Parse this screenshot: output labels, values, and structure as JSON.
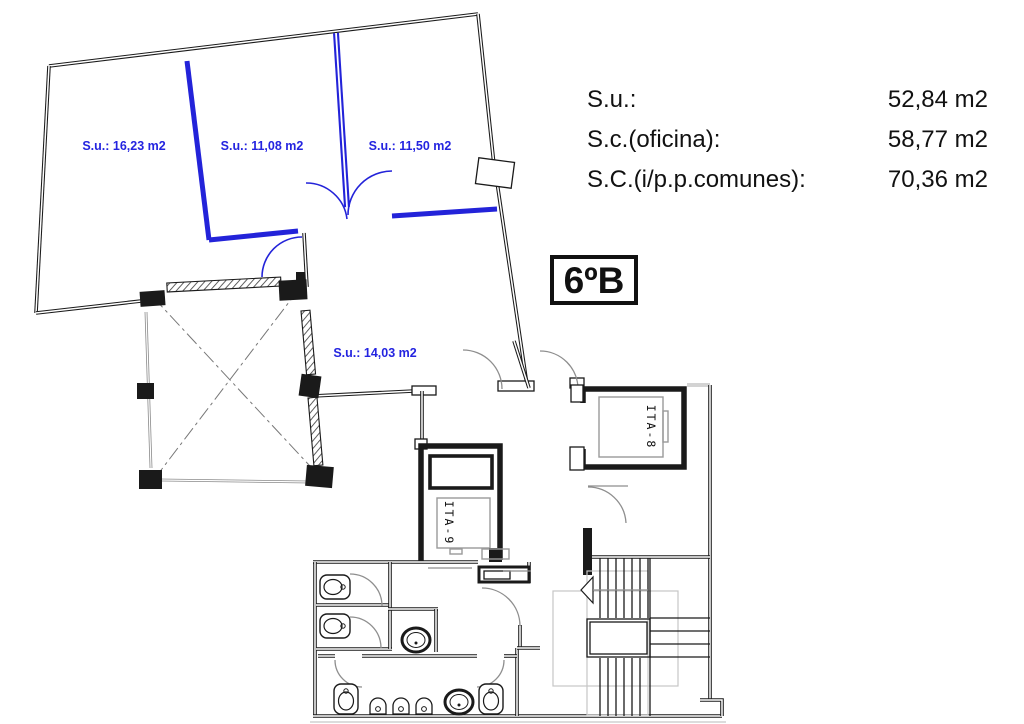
{
  "unit_box": {
    "label": "6ºB"
  },
  "legend": {
    "rows": [
      {
        "label": "S.u.:",
        "value": "52,84 m2"
      },
      {
        "label": "S.c.(oficina):",
        "value": "58,77 m2"
      },
      {
        "label": "S.C.(i/p.p.comunes):",
        "value": "70,36 m2"
      }
    ]
  },
  "room_labels": {
    "room1": "S.u.: 16,23 m2",
    "room2": "S.u.: 11,08 m2",
    "room3": "S.u.: 11,50 m2",
    "hall": "S.u.: 14,03 m2"
  },
  "elevators": {
    "ita8": "ITA-8",
    "ita9": "ITA-9"
  },
  "colors": {
    "partition_blue": "#2323d9",
    "label_blue": "#2424e0",
    "wall_black": "#1a1a1a",
    "window_gray": "#8a8a8a"
  }
}
